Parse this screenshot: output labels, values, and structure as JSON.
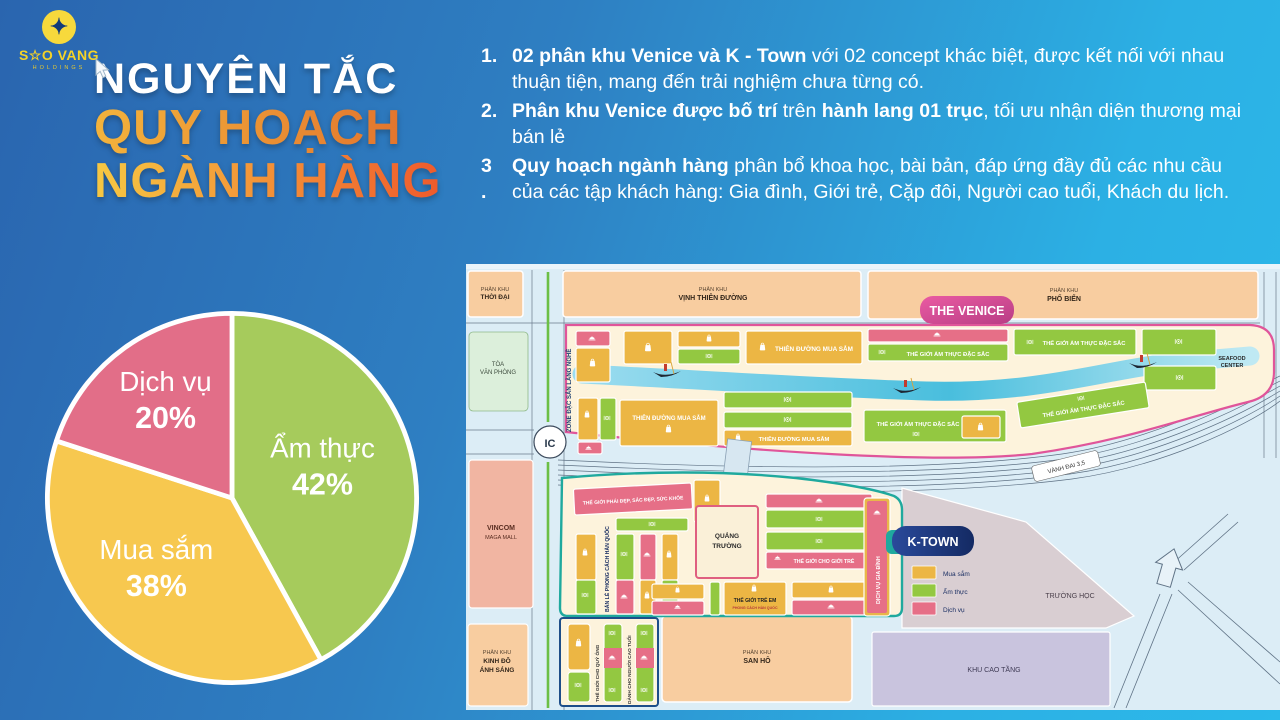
{
  "logo": {
    "star": "✦",
    "text": "S☆O VANG",
    "sub": "HOLDINGS"
  },
  "title": {
    "line1": "NGUYÊN TẮC",
    "line2": "QUY HOẠCH",
    "line3": "NGÀNH HÀNG"
  },
  "points": {
    "items": [
      {
        "num": "1.",
        "seg0": "02 phân khu Venice và K - Town",
        "seg1": " với 02 concept khác biệt, được kết nối với nhau thuận tiện, mang đến trải nghiệm chưa từng có."
      },
      {
        "num": "2.",
        "seg0": "Phân khu Venice được bố trí",
        "seg1": " trên ",
        "seg2": "hành lang 01 trục",
        "seg3": ", tối ưu nhận diện thương mại bán lẻ"
      },
      {
        "num": "3\n.",
        "seg0": "Quy hoạch ngành hàng",
        "seg1": " phân bổ khoa học, bài bản, đáp ứng đầy đủ các nhu cầu của các tập khách hàng: Gia đình, Giới trẻ, Cặp đôi, Người cao tuổi, Khách du lịch."
      }
    ]
  },
  "chart_data": {
    "type": "pie",
    "labels": [
      "Ẩm thực",
      "Mua sắm",
      "Dịch vụ"
    ],
    "values": [
      42,
      38,
      20
    ],
    "unit": "%",
    "colors": [
      "#a6cb5c",
      "#f7c84f",
      "#e26e88"
    ],
    "start_angle": "12 o'clock, clockwise",
    "legend_position": "labels inside slices"
  },
  "pie": {
    "slices": [
      {
        "name": "Ẩm thực",
        "pct": "42%"
      },
      {
        "name": "Mua sắm",
        "pct": "38%"
      },
      {
        "name": "Dịch vụ",
        "pct": "20%"
      }
    ]
  },
  "map": {
    "phan_khu": "PHÂN KHU",
    "zones": {
      "thoi_dai": "THỜI ĐẠI",
      "vinh_thien_duong": "VỊNH THIÊN ĐƯỜNG",
      "pho_bien": "PHỐ BIỂN",
      "kinh_do_1": "KINH ĐÔ",
      "kinh_do_2": "ÁNH SÁNG",
      "san_ho": "SAN HÔ"
    },
    "buildings": {
      "toa_1": "TÒA",
      "toa_2": "VĂN PHÒNG",
      "vincom_1": "VINCOM",
      "vincom_2": "MAGA MALL",
      "khu_cao_tang": "KHU CAO TẦNG",
      "truong_hoc": "TRƯỜNG HỌC",
      "ic": "IC",
      "vanh_dai": "VÀNH ĐAI 3,5"
    },
    "venice": {
      "badge": "THE VENICE",
      "zone_dac_san": "ZONE ĐẶC SẢN LÀNG NGHỀ",
      "shopping": "THIÊN ĐƯỜNG MUA SẮM",
      "food": "THẾ GIỚI ẨM THỰC ĐẶC SẮC",
      "seafood_1": "SEAFOOD",
      "seafood_2": "CENTER"
    },
    "ktown": {
      "badge": "K-TOWN",
      "beauty": "THẾ GIỚI PHÁI ĐẸP, SẮC ĐẸP, SỨC KHỎE",
      "retail_kr": "BÁN LẺ PHONG CÁCH HÀN QUỐC",
      "square_1": "QUẢNG",
      "square_2": "TRƯỜNG",
      "youth": "THẾ GIỚI CHO GIỚI TRẺ",
      "kids_1": "THẾ GIỚI TRẺ EM",
      "kids_2": "PHONG CÁCH HÀN QUỐC",
      "gentlemen": "THẾ GIỚI CHO QUÝ ÔNG",
      "elderly": "DÀNH CHO NGƯỜI CAO TUỔI",
      "family": "DỊCH VỤ GIA ĐÌNH",
      "legend": [
        {
          "label": "Mua sắm",
          "color": "#ecb644"
        },
        {
          "label": "Ẩm thực",
          "color": "#93c841"
        },
        {
          "label": "Dịch vụ",
          "color": "#e66f87"
        }
      ]
    }
  },
  "colors": {
    "bg_top_right": "#2bb9ea",
    "bg_bottom_left": "#2a65af",
    "title_gradient": [
      "#f3b33c",
      "#ef5a2c"
    ],
    "venice_border": "#e0559a",
    "ktown_border": "#1fa99e",
    "map_bg": "#dcedf6"
  }
}
